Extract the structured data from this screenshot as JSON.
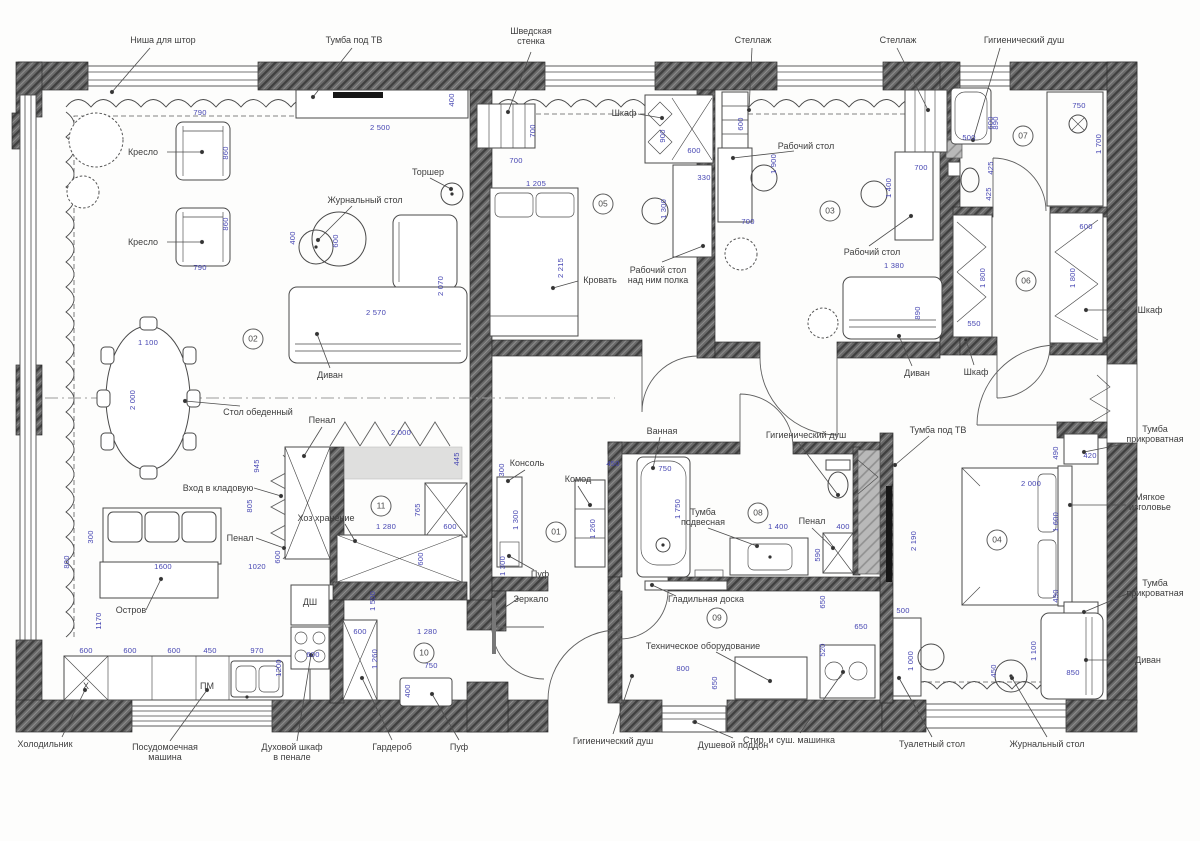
{
  "colors": {
    "dimension": "#4545b2",
    "wall": "#686868",
    "line": "#4a4a4a",
    "label": "#3e3e3e"
  },
  "rooms": [
    {
      "num": "02",
      "x": 253,
      "y": 339
    },
    {
      "num": "05",
      "x": 603,
      "y": 204
    },
    {
      "num": "03",
      "x": 830,
      "y": 211
    },
    {
      "num": "07",
      "x": 1023,
      "y": 136
    },
    {
      "num": "06",
      "x": 1026,
      "y": 281
    },
    {
      "num": "01",
      "x": 556,
      "y": 532
    },
    {
      "num": "11",
      "x": 381,
      "y": 506
    },
    {
      "num": "10",
      "x": 424,
      "y": 653
    },
    {
      "num": "08",
      "x": 758,
      "y": 513
    },
    {
      "num": "09",
      "x": 717,
      "y": 618
    },
    {
      "num": "04",
      "x": 997,
      "y": 540
    }
  ],
  "labels": [
    {
      "text": "Ниша для штор",
      "x": 163,
      "y": 40
    },
    {
      "text": "Тумба под ТВ",
      "x": 354,
      "y": 40
    },
    {
      "text": "Шведская\nстенка",
      "x": 531,
      "y": 36
    },
    {
      "text": "Стеллаж",
      "x": 753,
      "y": 40
    },
    {
      "text": "Стеллаж",
      "x": 898,
      "y": 40
    },
    {
      "text": "Гигиенический душ",
      "x": 1024,
      "y": 40
    },
    {
      "text": "Кресло",
      "x": 143,
      "y": 152
    },
    {
      "text": "Кресло",
      "x": 143,
      "y": 242
    },
    {
      "text": "Журнальный стол",
      "x": 365,
      "y": 200
    },
    {
      "text": "Торшер",
      "x": 428,
      "y": 172
    },
    {
      "text": "Шкаф",
      "x": 624,
      "y": 113
    },
    {
      "text": "Рабочий стол",
      "x": 806,
      "y": 146
    },
    {
      "text": "Кровать",
      "x": 600,
      "y": 280
    },
    {
      "text": "Рабочий стол\nнад ним полка",
      "x": 658,
      "y": 275
    },
    {
      "text": "Рабочий стол",
      "x": 872,
      "y": 252
    },
    {
      "text": "Диван",
      "x": 330,
      "y": 375
    },
    {
      "text": "Стол обеденный",
      "x": 258,
      "y": 412
    },
    {
      "text": "Диван",
      "x": 917,
      "y": 373
    },
    {
      "text": "Шкаф",
      "x": 976,
      "y": 372
    },
    {
      "text": "Шкаф",
      "x": 1150,
      "y": 310
    },
    {
      "text": "Пенал",
      "x": 322,
      "y": 420
    },
    {
      "text": "Вход в кладовую",
      "x": 218,
      "y": 488
    },
    {
      "text": "Хоз хранение",
      "x": 326,
      "y": 518
    },
    {
      "text": "Пенал",
      "x": 240,
      "y": 538
    },
    {
      "text": "Остров",
      "x": 131,
      "y": 610
    },
    {
      "text": "Х",
      "x": 86,
      "y": 686
    },
    {
      "text": "ПМ",
      "x": 207,
      "y": 686
    },
    {
      "text": "ДШ",
      "x": 310,
      "y": 602
    },
    {
      "text": "Консоль",
      "x": 527,
      "y": 463
    },
    {
      "text": "Пуф",
      "x": 540,
      "y": 574
    },
    {
      "text": "Зеркало",
      "x": 531,
      "y": 599
    },
    {
      "text": "Ванная",
      "x": 662,
      "y": 431
    },
    {
      "text": "Гигиенический душ",
      "x": 806,
      "y": 435
    },
    {
      "text": "Комод",
      "x": 578,
      "y": 479
    },
    {
      "text": "Тумба\nподвесная",
      "x": 703,
      "y": 517
    },
    {
      "text": "Пенал",
      "x": 812,
      "y": 521
    },
    {
      "text": "Гладильная доска",
      "x": 706,
      "y": 599
    },
    {
      "text": "Техническое оборудование",
      "x": 703,
      "y": 646
    },
    {
      "text": "Тумба под ТВ",
      "x": 938,
      "y": 430
    },
    {
      "text": "Тумба\nприкроватная",
      "x": 1155,
      "y": 434
    },
    {
      "text": "Мягкое\nизголовье",
      "x": 1150,
      "y": 502
    },
    {
      "text": "Тумба\nприкроватная",
      "x": 1155,
      "y": 588
    },
    {
      "text": "Диван",
      "x": 1148,
      "y": 660
    },
    {
      "text": "Холодильник",
      "x": 45,
      "y": 744
    },
    {
      "text": "Посудомоечная\nмашина",
      "x": 165,
      "y": 752
    },
    {
      "text": "Духовой шкаф\nв пенале",
      "x": 292,
      "y": 752
    },
    {
      "text": "Гардероб",
      "x": 392,
      "y": 747
    },
    {
      "text": "Пуф",
      "x": 459,
      "y": 747
    },
    {
      "text": "Гигиенический душ",
      "x": 613,
      "y": 741
    },
    {
      "text": "Душевой поддон",
      "x": 733,
      "y": 745
    },
    {
      "text": "Стир. и суш. машинка",
      "x": 789,
      "y": 740
    },
    {
      "text": "Туалетный стол",
      "x": 932,
      "y": 744
    },
    {
      "text": "Журнальный стол",
      "x": 1047,
      "y": 744
    }
  ],
  "dims": [
    {
      "t": "790",
      "x": 200,
      "y": 113
    },
    {
      "t": "860",
      "x": 226,
      "y": 153,
      "r": 1
    },
    {
      "t": "790",
      "x": 200,
      "y": 268
    },
    {
      "t": "860",
      "x": 226,
      "y": 224,
      "r": 1
    },
    {
      "t": "400",
      "x": 293,
      "y": 238,
      "r": 1
    },
    {
      "t": "600",
      "x": 336,
      "y": 241,
      "r": 1
    },
    {
      "t": "2 500",
      "x": 380,
      "y": 128
    },
    {
      "t": "400",
      "x": 452,
      "y": 100,
      "r": 1
    },
    {
      "t": "2 570",
      "x": 376,
      "y": 313
    },
    {
      "t": "2 070",
      "x": 441,
      "y": 286,
      "r": 1
    },
    {
      "t": "1 100",
      "x": 148,
      "y": 343
    },
    {
      "t": "2 000",
      "x": 133,
      "y": 400,
      "r": 1
    },
    {
      "t": "945",
      "x": 257,
      "y": 466,
      "r": 1
    },
    {
      "t": "805",
      "x": 250,
      "y": 506,
      "r": 1
    },
    {
      "t": "600",
      "x": 278,
      "y": 557,
      "r": 1
    },
    {
      "t": "300",
      "x": 91,
      "y": 537,
      "r": 1
    },
    {
      "t": "800",
      "x": 67,
      "y": 562,
      "r": 1
    },
    {
      "t": "1600",
      "x": 163,
      "y": 567
    },
    {
      "t": "1020",
      "x": 257,
      "y": 567
    },
    {
      "t": "1170",
      "x": 99,
      "y": 621,
      "r": 1
    },
    {
      "t": "600",
      "x": 86,
      "y": 651
    },
    {
      "t": "600",
      "x": 130,
      "y": 651
    },
    {
      "t": "600",
      "x": 174,
      "y": 651
    },
    {
      "t": "450",
      "x": 210,
      "y": 651
    },
    {
      "t": "970",
      "x": 257,
      "y": 651
    },
    {
      "t": "600",
      "x": 313,
      "y": 655
    },
    {
      "t": "1200",
      "x": 279,
      "y": 668,
      "r": 1
    },
    {
      "t": "2 000",
      "x": 401,
      "y": 433
    },
    {
      "t": "445",
      "x": 457,
      "y": 459,
      "r": 1
    },
    {
      "t": "765",
      "x": 418,
      "y": 510,
      "r": 1
    },
    {
      "t": "1 280",
      "x": 386,
      "y": 527
    },
    {
      "t": "600",
      "x": 450,
      "y": 527
    },
    {
      "t": "600",
      "x": 421,
      "y": 559,
      "r": 1
    },
    {
      "t": "1 500",
      "x": 373,
      "y": 601,
      "r": 1
    },
    {
      "t": "600",
      "x": 360,
      "y": 632
    },
    {
      "t": "1 280",
      "x": 427,
      "y": 632
    },
    {
      "t": "1 260",
      "x": 375,
      "y": 659,
      "r": 1
    },
    {
      "t": "750",
      "x": 431,
      "y": 666
    },
    {
      "t": "400",
      "x": 408,
      "y": 691,
      "r": 1
    },
    {
      "t": "300",
      "x": 502,
      "y": 470,
      "r": 1
    },
    {
      "t": "1 300",
      "x": 516,
      "y": 520,
      "r": 1
    },
    {
      "t": "1 300",
      "x": 503,
      "y": 566,
      "r": 1
    },
    {
      "t": "700",
      "x": 533,
      "y": 131,
      "r": 1
    },
    {
      "t": "700",
      "x": 516,
      "y": 161
    },
    {
      "t": "1 205",
      "x": 536,
      "y": 184
    },
    {
      "t": "2 215",
      "x": 561,
      "y": 268,
      "r": 1
    },
    {
      "t": "900",
      "x": 663,
      "y": 136,
      "r": 1
    },
    {
      "t": "600",
      "x": 694,
      "y": 151
    },
    {
      "t": "330",
      "x": 704,
      "y": 178
    },
    {
      "t": "1 300",
      "x": 664,
      "y": 209,
      "r": 1
    },
    {
      "t": "600",
      "x": 741,
      "y": 124,
      "r": 1
    },
    {
      "t": "1 900",
      "x": 774,
      "y": 164,
      "r": 1
    },
    {
      "t": "700",
      "x": 748,
      "y": 222
    },
    {
      "t": "600",
      "x": 991,
      "y": 123,
      "r": 1
    },
    {
      "t": "700",
      "x": 921,
      "y": 168
    },
    {
      "t": "1 400",
      "x": 889,
      "y": 188,
      "r": 1
    },
    {
      "t": "1 380",
      "x": 894,
      "y": 266
    },
    {
      "t": "890",
      "x": 918,
      "y": 313,
      "r": 1
    },
    {
      "t": "550",
      "x": 974,
      "y": 324
    },
    {
      "t": "500",
      "x": 969,
      "y": 138
    },
    {
      "t": "890",
      "x": 996,
      "y": 123,
      "r": 1
    },
    {
      "t": "750",
      "x": 1079,
      "y": 106
    },
    {
      "t": "1 700",
      "x": 1099,
      "y": 144,
      "r": 1
    },
    {
      "t": "425",
      "x": 991,
      "y": 168,
      "r": 1
    },
    {
      "t": "425",
      "x": 989,
      "y": 194,
      "r": 1
    },
    {
      "t": "600",
      "x": 1086,
      "y": 227
    },
    {
      "t": "1 800",
      "x": 983,
      "y": 278,
      "r": 1
    },
    {
      "t": "1 800",
      "x": 1073,
      "y": 278,
      "r": 1
    },
    {
      "t": "450",
      "x": 613,
      "y": 464
    },
    {
      "t": "750",
      "x": 665,
      "y": 469
    },
    {
      "t": "1 750",
      "x": 678,
      "y": 509,
      "r": 1
    },
    {
      "t": "1 260",
      "x": 593,
      "y": 529,
      "r": 1
    },
    {
      "t": "1 400",
      "x": 778,
      "y": 527
    },
    {
      "t": "400",
      "x": 843,
      "y": 527
    },
    {
      "t": "590",
      "x": 818,
      "y": 555,
      "r": 1
    },
    {
      "t": "650",
      "x": 823,
      "y": 602,
      "r": 1
    },
    {
      "t": "520",
      "x": 823,
      "y": 650,
      "r": 1
    },
    {
      "t": "650",
      "x": 861,
      "y": 627
    },
    {
      "t": "500",
      "x": 903,
      "y": 611
    },
    {
      "t": "800",
      "x": 683,
      "y": 669
    },
    {
      "t": "650",
      "x": 715,
      "y": 683,
      "r": 1
    },
    {
      "t": "490",
      "x": 1056,
      "y": 453,
      "r": 1
    },
    {
      "t": "420",
      "x": 1090,
      "y": 456
    },
    {
      "t": "2 000",
      "x": 1031,
      "y": 484
    },
    {
      "t": "1 600",
      "x": 1056,
      "y": 522,
      "r": 1
    },
    {
      "t": "490",
      "x": 1056,
      "y": 596,
      "r": 1
    },
    {
      "t": "2 190",
      "x": 914,
      "y": 541,
      "r": 1
    },
    {
      "t": "1 000",
      "x": 911,
      "y": 661,
      "r": 1
    },
    {
      "t": "450",
      "x": 994,
      "y": 671,
      "r": 1
    },
    {
      "t": "1 100",
      "x": 1034,
      "y": 651,
      "r": 1
    },
    {
      "t": "850",
      "x": 1073,
      "y": 673
    }
  ]
}
